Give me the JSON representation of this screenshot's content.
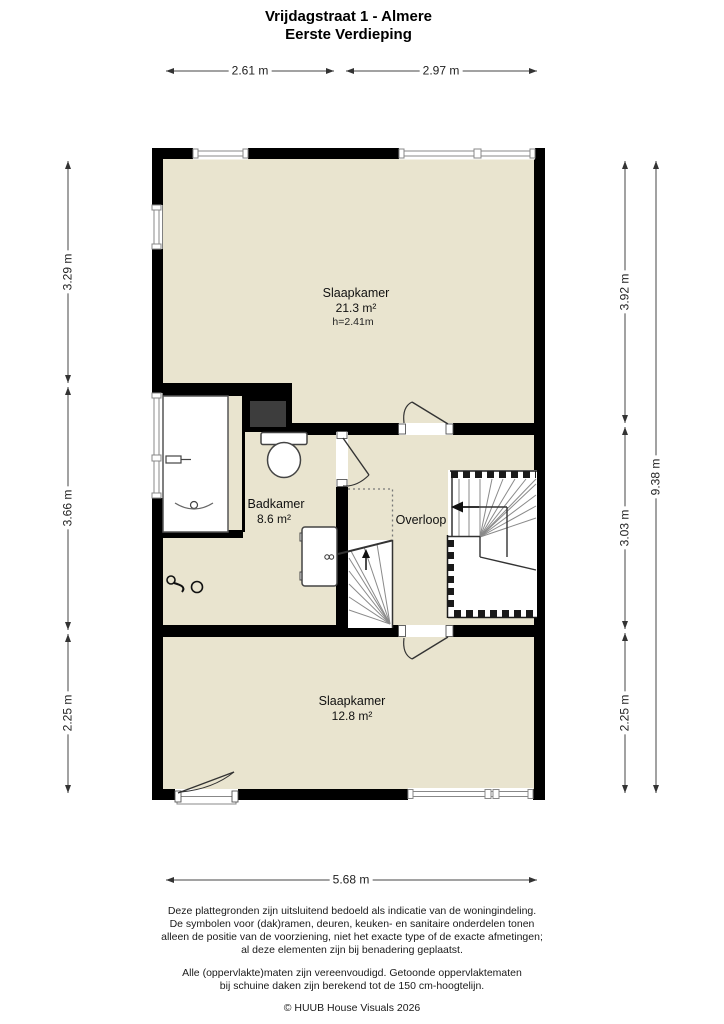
{
  "title": {
    "line1": "Vrijdagstraat 1 - Almere",
    "line2": "Eerste Verdieping"
  },
  "dims": {
    "top": [
      "2.61 m",
      "2.97 m"
    ],
    "left": [
      "3.29 m",
      "3.66 m",
      "2.25 m"
    ],
    "right": [
      "3.92 m",
      "3.03 m",
      "2.25 m"
    ],
    "right_total": "9.38 m",
    "bottom": "5.68 m"
  },
  "rooms": {
    "bedroom1": {
      "name": "Slaapkamer",
      "area": "21.3 m²",
      "ceiling": "h=2.41m"
    },
    "bathroom": {
      "name": "Badkamer",
      "area": "8.6 m²"
    },
    "landing": {
      "name": "Overloop"
    },
    "bedroom2": {
      "name": "Slaapkamer",
      "area": "12.8 m²"
    }
  },
  "footer": {
    "para1": [
      "Deze plattegronden zijn uitsluitend bedoeld als indicatie van de woningindeling.",
      "De symbolen voor (dak)ramen, deuren, keuken- en sanitaire onderdelen tonen",
      "alleen de positie van de voorziening, niet het exacte type of de exacte afmetingen;",
      "al deze elementen zijn bij benadering geplaatst."
    ],
    "para2": [
      "Alle (oppervlakte)maten zijn vereenvoudigd. Getoonde oppervlaktematen",
      "bij schuine daken zijn berekend tot de 150 cm-hoogtelijn."
    ],
    "copyright": "© HUUB House Visuals 2026"
  },
  "colors": {
    "floor": "#e9e4cf",
    "wall": "#000000",
    "shaft": "#3d3d3d",
    "stair_tread": "#8a8a8a",
    "dimension_line": "#444444"
  }
}
